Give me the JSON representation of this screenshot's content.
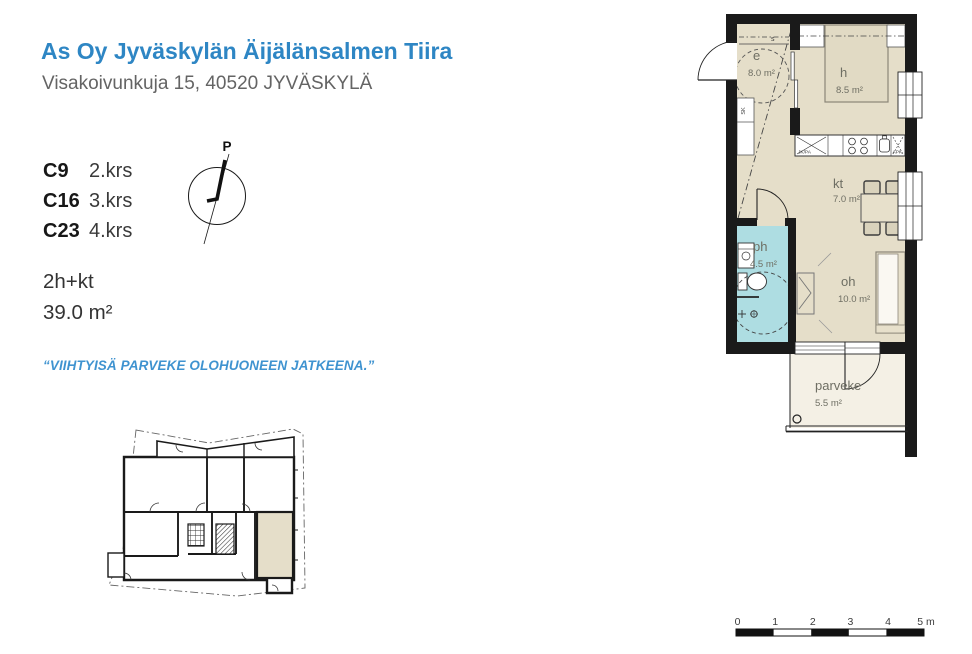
{
  "header": {
    "title": "As Oy Jyväskylän Äijälänsalmen Tiira",
    "address": "Visakoivunkuja 15, 40520 JYVÄSKYLÄ"
  },
  "apartments": [
    {
      "code": "C9",
      "floor": "2.krs"
    },
    {
      "code": "C16",
      "floor": "3.krs"
    },
    {
      "code": "C23",
      "floor": "4.krs"
    }
  ],
  "compass": {
    "north": "P"
  },
  "summary": {
    "layout": "2h+kt",
    "area": "39.0 m²"
  },
  "quote": "“VIIHTYISÄ PARVEKE OLOHUONEEN JATKEENA.”",
  "floorplan": {
    "rooms": [
      {
        "code": "e",
        "area": "8.0 m²"
      },
      {
        "code": "h",
        "area": "8.5 m²"
      },
      {
        "code": "kt",
        "area": "7.0 m²"
      },
      {
        "code": "ph",
        "area": "4.5 m²"
      },
      {
        "code": "oh",
        "area": "10.0 m²"
      },
      {
        "code": "parveke",
        "area": "5.5 m²"
      }
    ],
    "fixtures": {
      "fridge_freezer": "JK/PA",
      "dishwasher": "APK",
      "cleaning_closet": "SK",
      "coat_rack": "s"
    },
    "colors": {
      "floor_beige": "#e5dec9",
      "bathroom_cyan": "#aedde2",
      "balcony_cream": "#f4f0e5",
      "wall_black": "#1a1a1a",
      "accent_blue": "#2e86c4"
    }
  },
  "scalebar": {
    "ticks": [
      "0",
      "1",
      "2",
      "3",
      "4"
    ],
    "end_label": "5 m"
  }
}
